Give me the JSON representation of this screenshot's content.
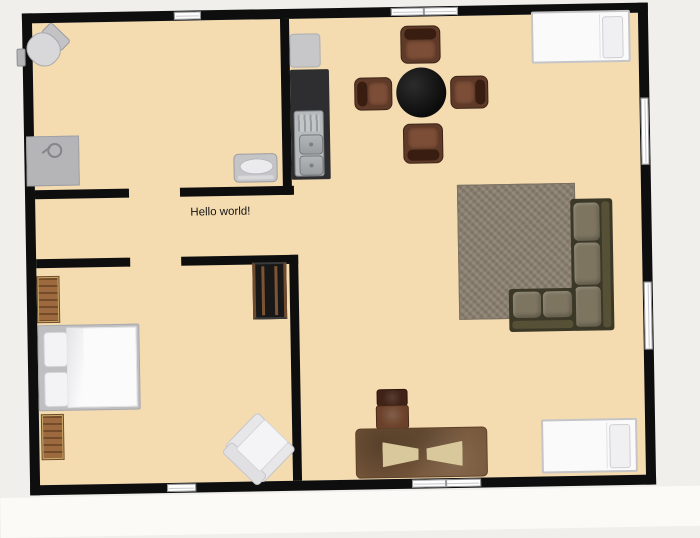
{
  "scene": {
    "app": "floor-plan-editor",
    "annotation": "Hello world!",
    "colors": {
      "outside_bg": "#f0efeb",
      "floor": "#f4dcb0",
      "wall": "#0e0e0e",
      "window_pane": "#fdfdfd",
      "rug": "#8b8070",
      "sofa_frame": "#3c3827",
      "sofa_cushion": "#7d7560",
      "dining_chair": "#5f3a28",
      "dining_table": "#0c0c0c",
      "desk": "#77573a",
      "desk_inlay": "#d9c89b",
      "bench_wood": "#9c6a3e",
      "appliance_gray": "#c7c7ca",
      "counter_dark": "#2e2e30",
      "bed_white": "#fafafb",
      "bed_frame": "#c5c5c8"
    },
    "furniture": [
      {
        "id": "toilet"
      },
      {
        "id": "shower-tray"
      },
      {
        "id": "wash-basin"
      },
      {
        "id": "fridge"
      },
      {
        "id": "kitchen-counter"
      },
      {
        "id": "kitchen-sink"
      },
      {
        "id": "dining-table"
      },
      {
        "id": "dining-chair-north"
      },
      {
        "id": "dining-chair-south"
      },
      {
        "id": "dining-chair-west"
      },
      {
        "id": "dining-chair-east"
      },
      {
        "id": "single-bed-top-right"
      },
      {
        "id": "single-bed-bottom-right"
      },
      {
        "id": "double-bed"
      },
      {
        "id": "bench-top"
      },
      {
        "id": "bench-bottom"
      },
      {
        "id": "wardrobe"
      },
      {
        "id": "rug"
      },
      {
        "id": "corner-sofa"
      },
      {
        "id": "armchair"
      },
      {
        "id": "office-chair"
      },
      {
        "id": "desk"
      }
    ],
    "windows": [
      {
        "id": "window-top-left",
        "wall": "top"
      },
      {
        "id": "window-top-right",
        "wall": "top"
      },
      {
        "id": "window-right-upper",
        "wall": "right"
      },
      {
        "id": "window-right-lower",
        "wall": "right"
      },
      {
        "id": "window-bottom-left",
        "wall": "bottom"
      },
      {
        "id": "window-bottom-right",
        "wall": "bottom"
      }
    ]
  }
}
